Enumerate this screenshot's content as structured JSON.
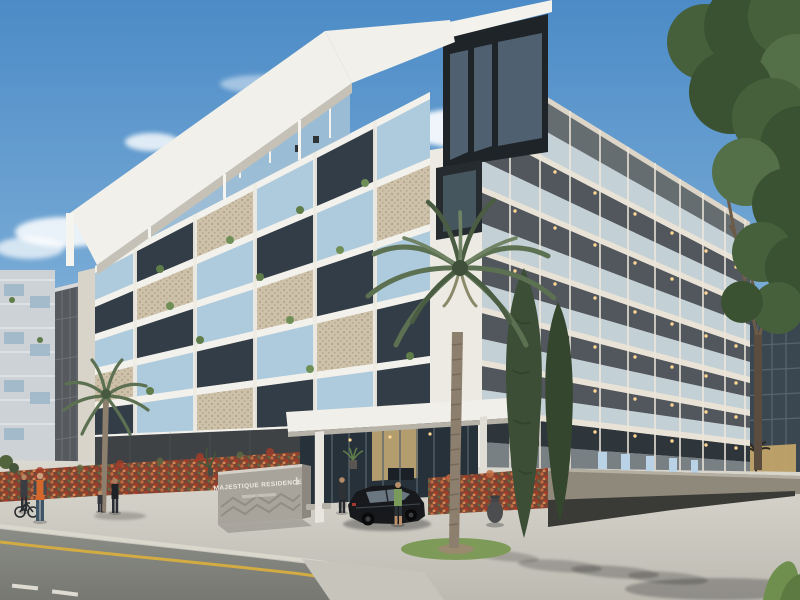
{
  "scene": {
    "type": "architectural-exterior-render",
    "subject": "modern low-rise residential apartment building at a street corner, daytime",
    "elements": [
      "six-storey cream apartment building with rooftop pergola frame",
      "balconies with glass railings and decorative panels",
      "warm soffit lights on the side facade",
      "entrance canopy with glass lobby",
      "monument sign with chevron relief",
      "flowering red hedge along the fence",
      "tall palm tree and cypress trees",
      "large green tree at right",
      "neighbouring buildings left and right",
      "asphalt road with yellow edge line and white dashes",
      "pedestrians, cyclist, black sedan at the driveway"
    ]
  },
  "sign": {
    "line1": "MAJESTIQUE RESIDENCE"
  },
  "palette": {
    "sky_top": "#4c8bc7",
    "sky_horizon": "#d3e3ee",
    "facade_light": "#e9e6df",
    "facade_warm": "#ddd5c7",
    "slab_white": "#f3f1ec",
    "glass_blue": "#aecbdd",
    "window_dark": "#333d47",
    "panel_beige": "#cdc1a9",
    "soffit_light": "#ffd793",
    "hedge_red": "#a63c28",
    "hedge_orange": "#c06a3e",
    "tree_green": "#46603c",
    "palm_green": "#5c7052",
    "road_asphalt": "#82847e",
    "road_line_yellow": "#d2ab43",
    "pavement": "#d9d6ce",
    "wall_taupe": "#8f897c",
    "car_black": "#17191c",
    "vest_orange": "#d4682c",
    "sign_concrete": "#a8a49b"
  }
}
